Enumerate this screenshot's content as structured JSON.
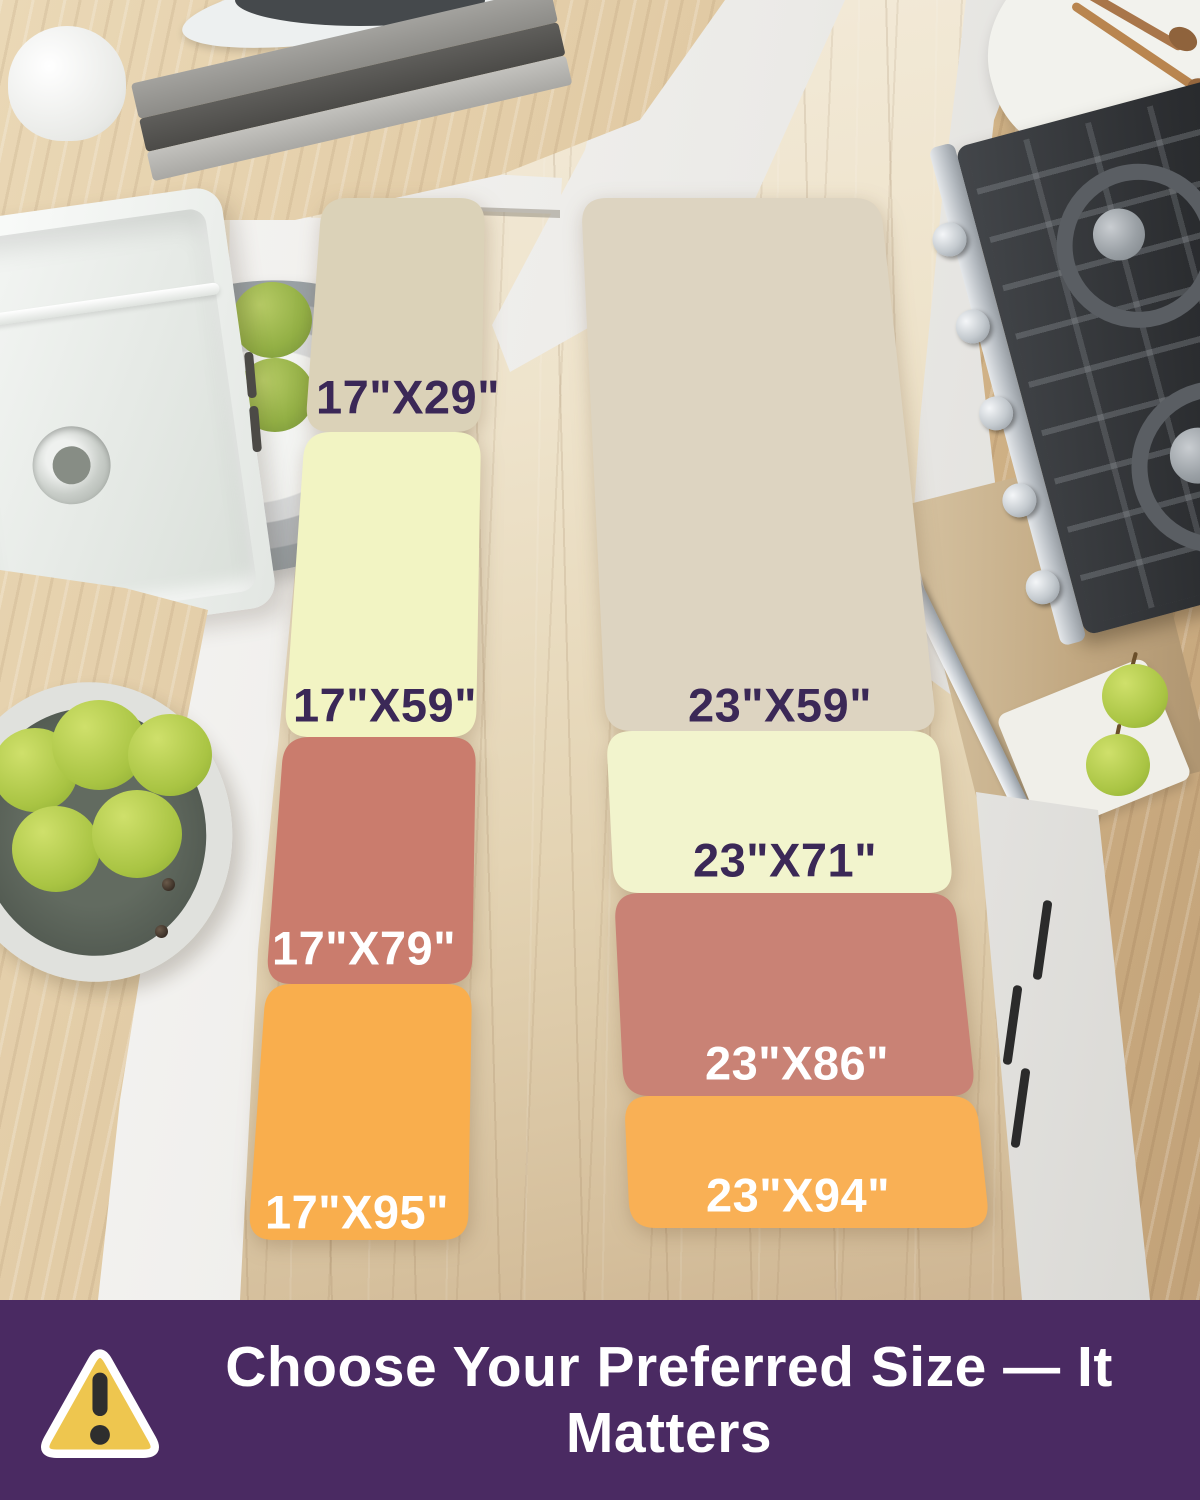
{
  "runners": {
    "left": {
      "segments": [
        {
          "size": "17\"X29\"",
          "color": "#dbd2b8",
          "text_color": "#3b2857"
        },
        {
          "size": "17\"X59\"",
          "color": "#f2f4c3",
          "text_color": "#3b2857"
        },
        {
          "size": "17\"X79\"",
          "color": "#ca7c6d",
          "text_color": "#ffffff"
        },
        {
          "size": "17\"X95\"",
          "color": "#f9ae4d",
          "text_color": "#ffffff"
        }
      ]
    },
    "right": {
      "segments": [
        {
          "size": "23\"X59\"",
          "color": "#ddd4c1",
          "text_color": "#3b2857"
        },
        {
          "size": "23\"X71\"",
          "color": "#f2f4cd",
          "text_color": "#3b2857"
        },
        {
          "size": "23\"X86\"",
          "color": "#c98275",
          "text_color": "#ffffff"
        },
        {
          "size": "23\"X94\"",
          "color": "#f9b055",
          "text_color": "#ffffff"
        }
      ]
    }
  },
  "banner": {
    "text": "Choose Your Preferred Size — It Matters",
    "background": "#4a2a62",
    "text_color": "#ffffff",
    "icon": {
      "name": "warning-triangle-icon",
      "fill": "#eec64f",
      "border_color": "#ffffff",
      "mark_color": "#2e2e2e"
    }
  }
}
